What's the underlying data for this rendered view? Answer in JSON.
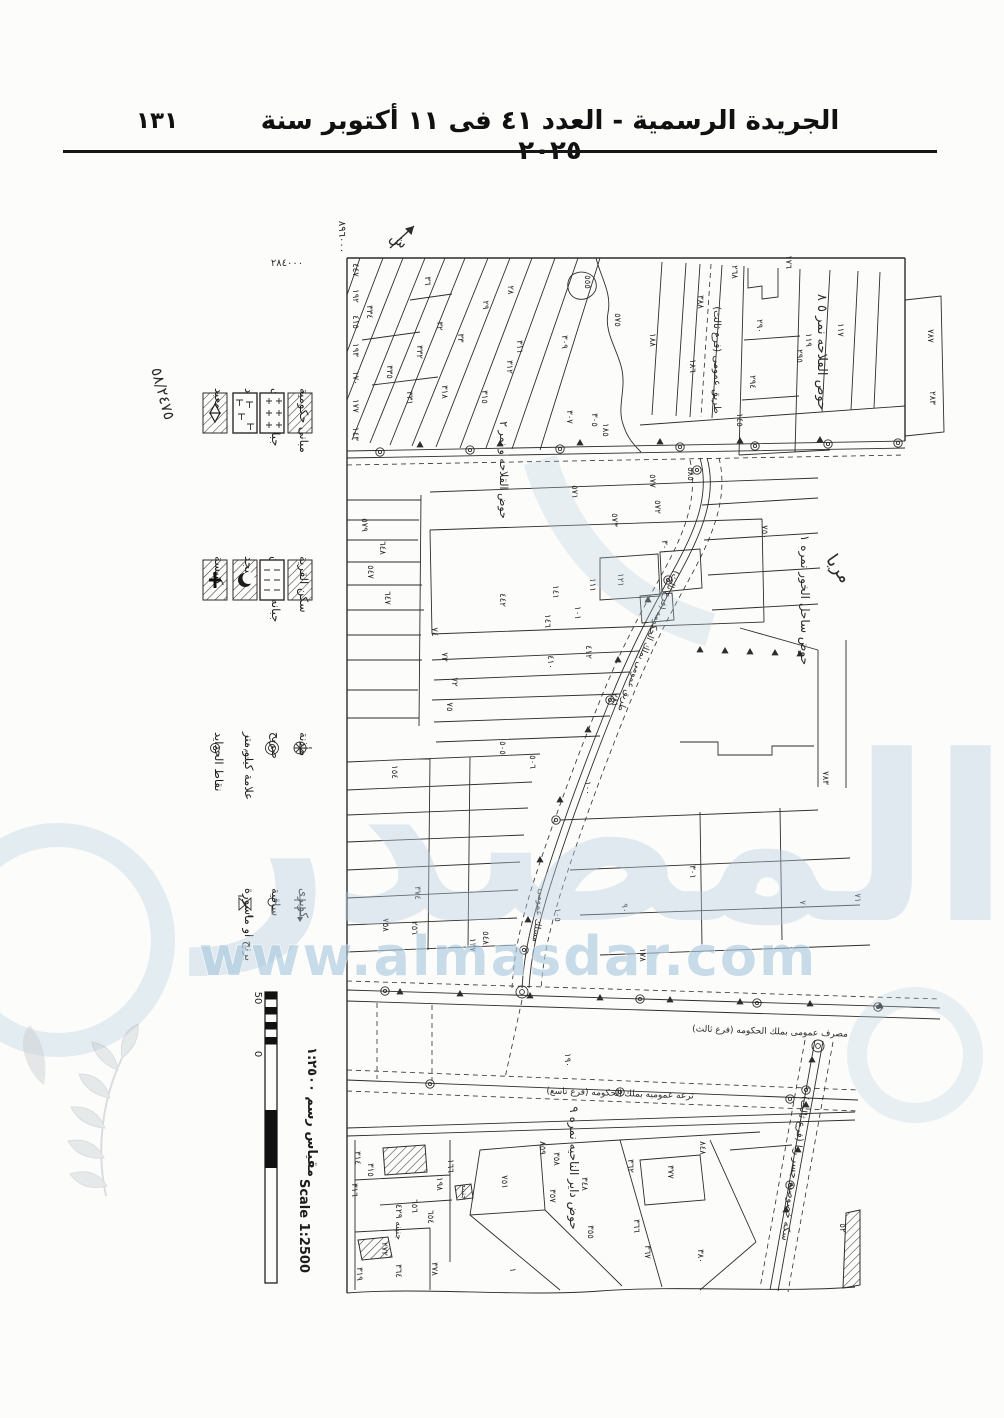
{
  "header": {
    "page_number": "١٣١",
    "title": "الجريدة الرسمية - العدد ٤١ فى ١١ أكتوبر سنة ٢٠٢٥"
  },
  "legend": {
    "buildings_group": [
      {
        "label": "مبانى حكومية"
      },
      {
        "label": "جبانه نصارى"
      },
      {
        "label": "جبانه يهود"
      },
      {
        "label": "معبد"
      }
    ],
    "village_group": [
      {
        "label": "سكن القرية"
      },
      {
        "label": "جبانه مسلمين"
      },
      {
        "label": "مسجد"
      },
      {
        "label": "كنيسة"
      }
    ],
    "symbols_group": [
      {
        "label": "مأذنة"
      },
      {
        "label": "ضريح"
      },
      {
        "label": "علامة كيلو متر"
      },
      {
        "label": "نقاط الحدايد"
      }
    ],
    "structures_group": [
      {
        "label": "كوبرى"
      },
      {
        "label": "ساقية"
      },
      {
        "label": "برنج او ماسورة"
      }
    ]
  },
  "scale": {
    "arabic_label": "مقياس رسم ١:٢٥٠٠",
    "english_label": "Scale 1:2500",
    "tick_50": "50",
    "tick_0": "0"
  },
  "watermark": {
    "url_text": "www.almasdar.com",
    "logo_text": "المصدر"
  },
  "map": {
    "annotations": [
      {
        "t": "ش",
        "x": 396,
        "y": 244,
        "r": 35,
        "s": 14
      },
      {
        "t": "٨٩٦٠٠٠",
        "x": 339,
        "y": 237,
        "r": 90,
        "s": 10
      },
      {
        "t": "٢٨٤٠٠٠",
        "x": 287,
        "y": 266,
        "r": 0,
        "s": 10
      },
      {
        "t": "٥٨/٢٤٧٥",
        "x": 158,
        "y": 395,
        "r": 75,
        "s": 15
      },
      {
        "t": "حوض القلاحه نمر ٥ ٨",
        "x": 818,
        "y": 352,
        "r": 90,
        "s": 13
      },
      {
        "t": "طريق عمومى (فرع ثالث)",
        "x": 714,
        "y": 360,
        "r": 90,
        "s": 10
      },
      {
        "t": "حوض القلاحه و نمر ٢",
        "x": 500,
        "y": 470,
        "r": 90,
        "s": 11
      },
      {
        "t": "حوض ساحل الخور نمره ١",
        "x": 801,
        "y": 600,
        "r": 90,
        "s": 12
      },
      {
        "t": "مريا",
        "x": 834,
        "y": 572,
        "r": 55,
        "s": 18
      },
      {
        "t": "حوض داير الناحيه نمره ٩",
        "x": 570,
        "y": 1168,
        "r": 90,
        "s": 12
      },
      {
        "t": "طريق عمومى بملك الحكومه (فرع ثالث)",
        "x": 646,
        "y": 640,
        "r": 112,
        "s": 9
      },
      {
        "t": "مسلك عمومى",
        "x": 536,
        "y": 915,
        "r": 97,
        "s": 9
      },
      {
        "t": "مصرف عمومى بملك الحكومه (فرع ثالث)",
        "x": 770,
        "y": 1034,
        "r": 2,
        "s": 9
      },
      {
        "t": "ترعه عموميه بملك الحكومه (فرع تاسع)",
        "x": 620,
        "y": 1096,
        "r": 2,
        "s": 9
      },
      {
        "t": "سكه خصوصيه جسر ريا (فرع ثالث)",
        "x": 792,
        "y": 1168,
        "r": 98,
        "s": 10
      },
      {
        "t": "جنينه ٤٢٩",
        "x": 396,
        "y": 1222,
        "r": 90,
        "s": 9
      },
      {
        "t": "جنينه",
        "x": 462,
        "y": 1192,
        "r": 90,
        "s": 8
      }
    ],
    "parcel_labels": [
      {
        "t": "٤٤٧",
        "x": 353,
        "y": 270
      },
      {
        "t": "١٩٢",
        "x": 353,
        "y": 296
      },
      {
        "t": "٤١٥",
        "x": 353,
        "y": 322
      },
      {
        "t": "١٩٣",
        "x": 353,
        "y": 350
      },
      {
        "t": "١٧٠",
        "x": 353,
        "y": 378
      },
      {
        "t": "١٧٧",
        "x": 353,
        "y": 406
      },
      {
        "t": "١٤٣",
        "x": 353,
        "y": 434
      },
      {
        "t": "٣٣٤",
        "x": 367,
        "y": 312
      },
      {
        "t": "٣٣٥",
        "x": 387,
        "y": 372
      },
      {
        "t": "٣٦",
        "x": 425,
        "y": 281
      },
      {
        "t": "٣٢",
        "x": 437,
        "y": 326
      },
      {
        "t": "٣٣",
        "x": 458,
        "y": 338
      },
      {
        "t": "٣٣٢",
        "x": 417,
        "y": 352
      },
      {
        "t": "٣٣١",
        "x": 407,
        "y": 398
      },
      {
        "t": "٣١٨",
        "x": 442,
        "y": 392
      },
      {
        "t": "٢٩",
        "x": 483,
        "y": 305
      },
      {
        "t": "٢٨",
        "x": 508,
        "y": 290
      },
      {
        "t": "٣١٥",
        "x": 482,
        "y": 397
      },
      {
        "t": "٣١١",
        "x": 517,
        "y": 347
      },
      {
        "t": "٣١٢",
        "x": 507,
        "y": 367
      },
      {
        "t": "٣٠٩",
        "x": 562,
        "y": 342
      },
      {
        "t": "٥٥٥",
        "x": 585,
        "y": 282
      },
      {
        "t": "٥٧٥",
        "x": 615,
        "y": 320
      },
      {
        "t": "٣٠٧",
        "x": 567,
        "y": 417
      },
      {
        "t": "٣٠٥",
        "x": 592,
        "y": 420
      },
      {
        "t": "١٨٥",
        "x": 603,
        "y": 430
      },
      {
        "t": "١٨٨",
        "x": 650,
        "y": 340
      },
      {
        "t": "٢٦٨",
        "x": 732,
        "y": 272
      },
      {
        "t": "١٧٦",
        "x": 786,
        "y": 262
      },
      {
        "t": "٣٨٨",
        "x": 698,
        "y": 302
      },
      {
        "t": "١٨٦",
        "x": 690,
        "y": 366
      },
      {
        "t": "٢٩٠",
        "x": 757,
        "y": 326
      },
      {
        "t": "٢٩٤",
        "x": 750,
        "y": 382
      },
      {
        "t": "٢٩٥",
        "x": 797,
        "y": 356
      },
      {
        "t": "١١٩",
        "x": 806,
        "y": 340
      },
      {
        "t": "١١٧",
        "x": 838,
        "y": 330
      },
      {
        "t": "٧٨٧",
        "x": 928,
        "y": 336
      },
      {
        "t": "٢٨٣",
        "x": 930,
        "y": 398
      },
      {
        "t": "١٤٥",
        "x": 737,
        "y": 420
      },
      {
        "t": "٥٧١",
        "x": 572,
        "y": 492
      },
      {
        "t": "٥٧٧",
        "x": 650,
        "y": 481
      },
      {
        "t": "٥٨٥",
        "x": 688,
        "y": 474
      },
      {
        "t": "٥٧٣",
        "x": 612,
        "y": 520
      },
      {
        "t": "٥٧٢",
        "x": 655,
        "y": 507
      },
      {
        "t": "٧٥٠",
        "x": 762,
        "y": 532
      },
      {
        "t": "٣٠٠",
        "x": 662,
        "y": 547
      },
      {
        "t": "٤٤٢",
        "x": 500,
        "y": 600
      },
      {
        "t": "١٤١",
        "x": 553,
        "y": 592
      },
      {
        "t": "١١١",
        "x": 590,
        "y": 585
      },
      {
        "t": "١٢١",
        "x": 618,
        "y": 580
      },
      {
        "t": "١٤٦",
        "x": 545,
        "y": 621
      },
      {
        "t": "١٠١",
        "x": 575,
        "y": 613
      },
      {
        "t": "٤١٠",
        "x": 548,
        "y": 662
      },
      {
        "t": "٤١٢",
        "x": 586,
        "y": 652
      },
      {
        "t": "٧٤",
        "x": 432,
        "y": 632
      },
      {
        "t": "٧٣",
        "x": 442,
        "y": 657
      },
      {
        "t": "٧٢",
        "x": 452,
        "y": 682
      },
      {
        "t": "٧٥",
        "x": 447,
        "y": 707
      },
      {
        "t": "١٥٤",
        "x": 392,
        "y": 772
      },
      {
        "t": "٥٧٩",
        "x": 362,
        "y": 525
      },
      {
        "t": "٦٤٨",
        "x": 380,
        "y": 548
      },
      {
        "t": "٥٤٧",
        "x": 368,
        "y": 572
      },
      {
        "t": "٦٤٧",
        "x": 385,
        "y": 598
      },
      {
        "t": "٢٨١",
        "x": 612,
        "y": 700
      },
      {
        "t": "٧٨٣",
        "x": 823,
        "y": 778
      },
      {
        "t": "٥٠٥",
        "x": 500,
        "y": 748
      },
      {
        "t": "٥٠٦",
        "x": 530,
        "y": 762
      },
      {
        "t": "١٠٠",
        "x": 585,
        "y": 788
      },
      {
        "t": "٣٠١",
        "x": 690,
        "y": 872
      },
      {
        "t": "٧٠",
        "x": 800,
        "y": 905
      },
      {
        "t": "٧١",
        "x": 855,
        "y": 898
      },
      {
        "t": "١٧٨",
        "x": 640,
        "y": 955
      },
      {
        "t": "٣٧٤",
        "x": 415,
        "y": 893
      },
      {
        "t": "٧٥٨",
        "x": 383,
        "y": 925
      },
      {
        "t": "٢٥٦",
        "x": 412,
        "y": 928
      },
      {
        "t": "١٣٧",
        "x": 470,
        "y": 945
      },
      {
        "t": "٥٤٨",
        "x": 483,
        "y": 938
      },
      {
        "t": "٩٠",
        "x": 622,
        "y": 908
      },
      {
        "t": "١٠٥",
        "x": 555,
        "y": 915
      },
      {
        "t": "١٩٠",
        "x": 565,
        "y": 1060
      },
      {
        "t": "٣١٤",
        "x": 355,
        "y": 1158
      },
      {
        "t": "٣١٥",
        "x": 368,
        "y": 1170
      },
      {
        "t": "١٦٦",
        "x": 448,
        "y": 1166
      },
      {
        "t": "١٩٨",
        "x": 437,
        "y": 1184
      },
      {
        "t": "٦٥٦",
        "x": 412,
        "y": 1206
      },
      {
        "t": "٦٥٤",
        "x": 428,
        "y": 1217
      },
      {
        "t": "٧٥١",
        "x": 502,
        "y": 1182
      },
      {
        "t": "٨٥٩",
        "x": 540,
        "y": 1148
      },
      {
        "t": "٣٥٨",
        "x": 554,
        "y": 1159
      },
      {
        "t": "٣٤٨",
        "x": 582,
        "y": 1184
      },
      {
        "t": "٣٥٧",
        "x": 550,
        "y": 1196
      },
      {
        "t": "٣٦٢",
        "x": 628,
        "y": 1166
      },
      {
        "t": "٣٦٦",
        "x": 634,
        "y": 1226
      },
      {
        "t": "٣٦٧",
        "x": 645,
        "y": 1252
      },
      {
        "t": "٣٥٥",
        "x": 588,
        "y": 1232
      },
      {
        "t": "١",
        "x": 510,
        "y": 1270
      },
      {
        "t": "٣٦٤",
        "x": 396,
        "y": 1271
      },
      {
        "t": "٣٧٨",
        "x": 432,
        "y": 1269
      },
      {
        "t": "٣١٩",
        "x": 357,
        "y": 1274
      },
      {
        "t": "٢٧٢",
        "x": 382,
        "y": 1249
      },
      {
        "t": "٣٧٧",
        "x": 668,
        "y": 1172
      },
      {
        "t": "٨٤٨",
        "x": 700,
        "y": 1148
      },
      {
        "t": "٣٨٠",
        "x": 698,
        "y": 1256
      },
      {
        "t": "٥٢",
        "x": 840,
        "y": 1228
      },
      {
        "t": "٣١٦",
        "x": 352,
        "y": 1190
      }
    ]
  }
}
